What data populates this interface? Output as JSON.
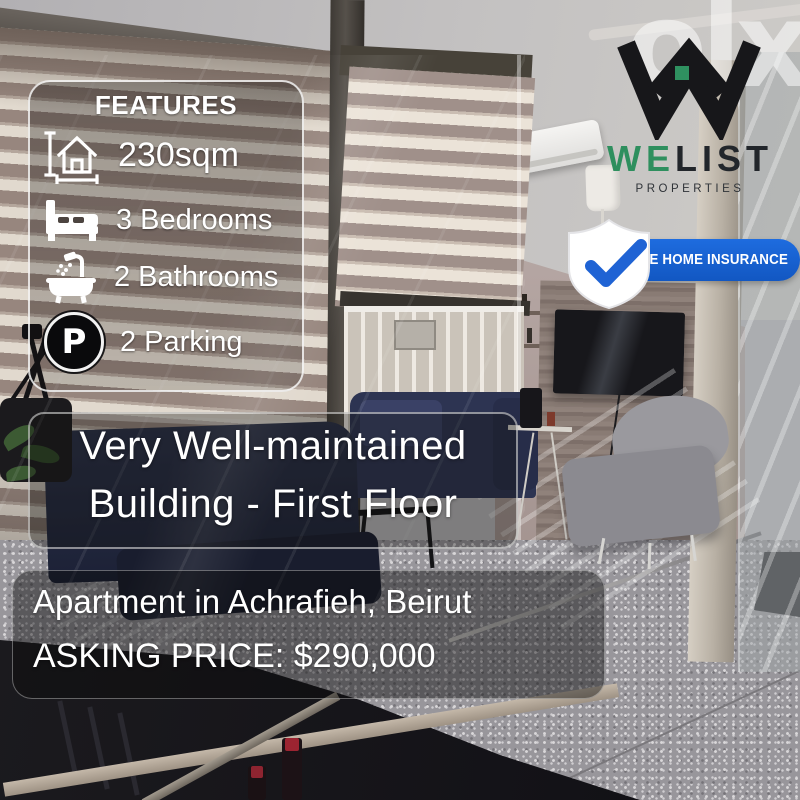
{
  "branding": {
    "olx_logo": "olx",
    "welist_we": "WE",
    "welist_list": "LIST",
    "properties": "PROPERTIES",
    "insurance_badge": "FREE HOME INSURANCE"
  },
  "features": {
    "title": "FEATURES",
    "parking_symbol": "P",
    "items": [
      {
        "icon": "area-icon",
        "label": "230sqm"
      },
      {
        "icon": "bed-icon",
        "label": "3 Bedrooms"
      },
      {
        "icon": "bath-icon",
        "label": "2 Bathrooms"
      },
      {
        "icon": "parking-icon",
        "label": "2 Parking"
      }
    ]
  },
  "headline": {
    "line1": "Very Well-maintained",
    "line2": "Building - First Floor"
  },
  "listing": {
    "location": "Apartment in Achrafieh, Beirut",
    "price": "ASKING PRICE: $290,000"
  },
  "colors": {
    "brand_green": "#2E8F5E",
    "brand_dark": "#22262B",
    "insurance_blue": "#1B63D4",
    "overlay_text": "#FFFFFF"
  }
}
